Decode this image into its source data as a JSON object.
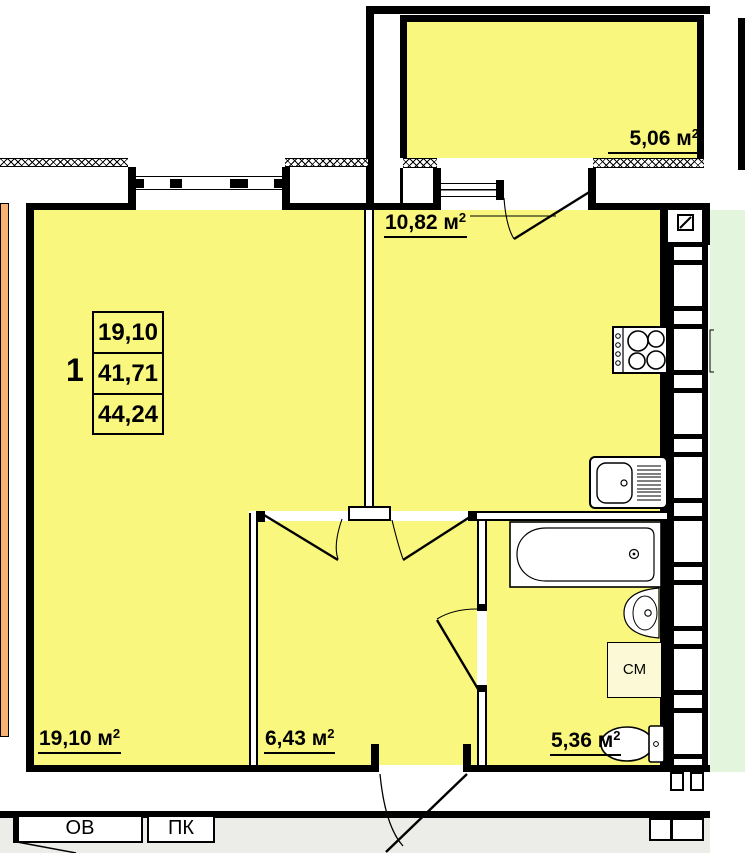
{
  "plan": {
    "unit": {
      "number": "1",
      "stats": {
        "living_area": "19,10",
        "area_no_balcony": "41,71",
        "total_area": "44,24"
      }
    },
    "rooms": {
      "balcony": {
        "text": "5,06 м",
        "sup": "2"
      },
      "kitchen": {
        "text": "10,82 м",
        "sup": "2"
      },
      "living": {
        "text": "19,10 м",
        "sup": "2"
      },
      "hallway": {
        "text": "6,43 м",
        "sup": "2"
      },
      "bathroom": {
        "text": "5,36 м",
        "sup": "2"
      }
    },
    "appliances": {
      "washing_machine": "СМ"
    },
    "corridor": {
      "ov_label": "ОВ",
      "pk_label": "ПК"
    },
    "colors": {
      "room_fill": "#FAF77E",
      "appliance_fill": "#FCFAD6",
      "left_neighbor_fill": "#F7B273",
      "right_neighbor_fill": "#E3F5DC",
      "corridor_fill": "#ECECE9",
      "wall": "#000000"
    }
  }
}
